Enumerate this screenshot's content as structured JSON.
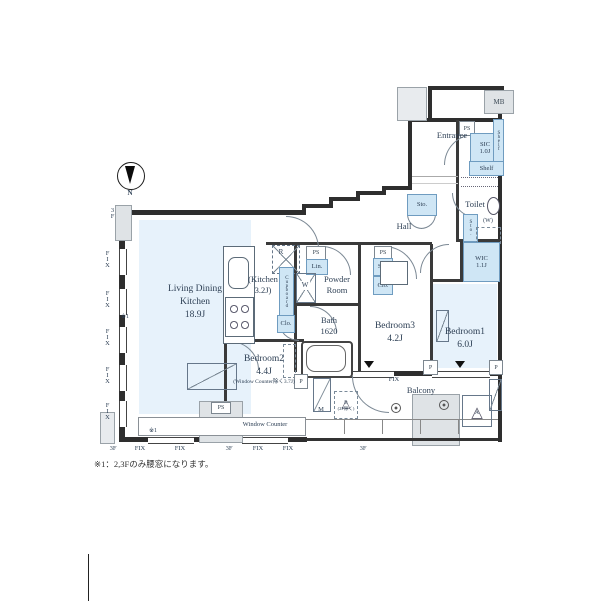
{
  "plan": {
    "compass_label": "N",
    "footnote": "※1：2,3Fのみ腰窓になります。"
  },
  "rooms": {
    "ldk": {
      "line1": "Living Dining",
      "line2": "Kitchen",
      "size": "18.9J"
    },
    "kitchen": {
      "line1": "(Kitchen",
      "line2": "3.2J)"
    },
    "powder_room": {
      "line1": "Powder",
      "line2": "Room"
    },
    "bath": {
      "name": "Bath",
      "size": "1620"
    },
    "bedroom1": {
      "name": "Bedroom1",
      "size": "6.0J"
    },
    "bedroom2": {
      "name": "Bedroom2",
      "size": "4.4J",
      "note": "(Window Counter除く3.7J)"
    },
    "bedroom3": {
      "name": "Bedroom3",
      "size": "4.2J"
    },
    "wic": {
      "name": "WIC",
      "size": "1.1J"
    },
    "sic": {
      "name": "SIC",
      "size": "1.0J"
    },
    "toilet": {
      "name": "Toilet"
    },
    "hall": {
      "name": "Hall"
    },
    "entrance": {
      "name": "Entrance"
    },
    "balcony": {
      "name": "Balcony"
    },
    "window_counter": {
      "name": "Window Counter"
    }
  },
  "labels": {
    "mb": "MB",
    "ps": "PS",
    "lin": "Lin.",
    "sto": "Sto.",
    "clo": "Clo.",
    "shelf": "Shelf",
    "cupboard": "Cupboard",
    "fridge": "R",
    "washer": "W",
    "washer_space": "(W)",
    "mirror": "M",
    "pillar": "P",
    "hatch_b": "B",
    "hatch_b_note": "(2F除く)",
    "hatch_a": "A",
    "fix": "FIX",
    "floor": "3F",
    "note_ref": "※1"
  }
}
